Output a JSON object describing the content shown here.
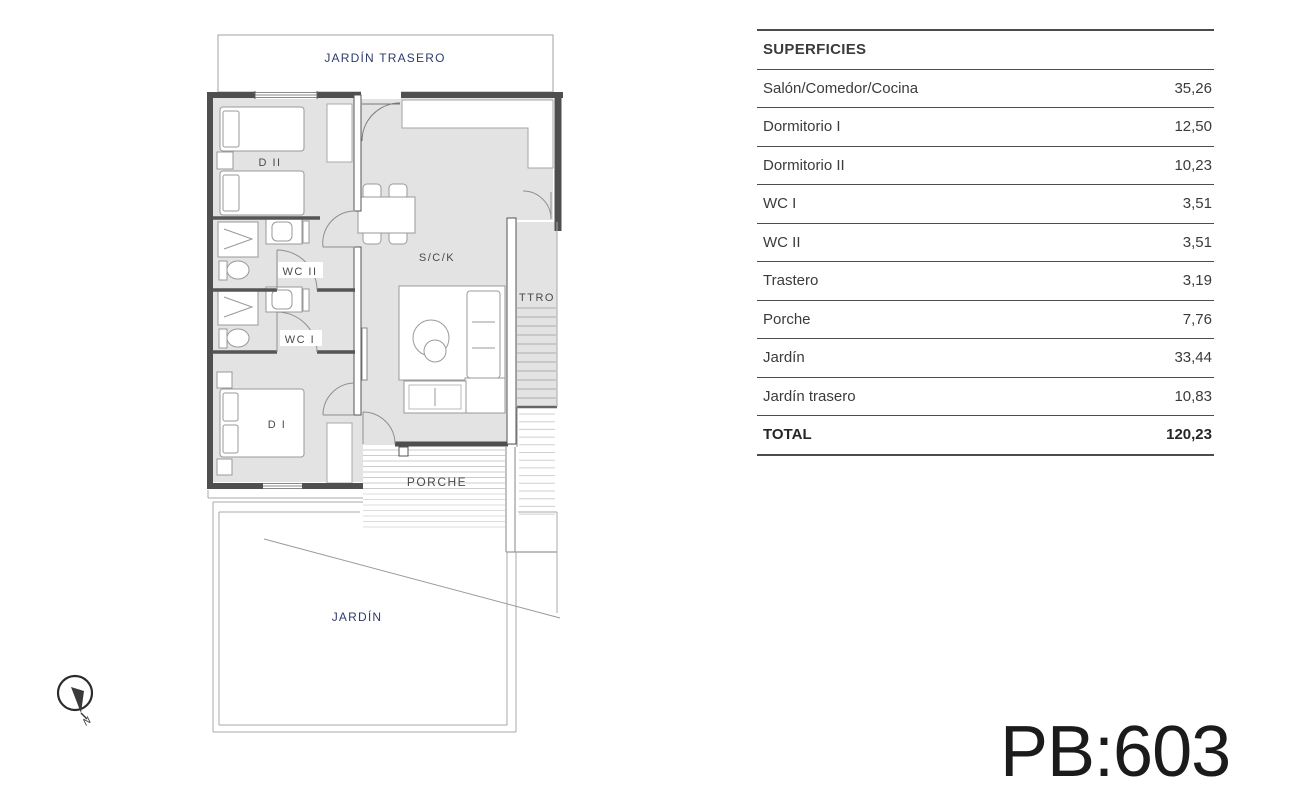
{
  "floor_plan": {
    "labels": {
      "jardin_trasero": "JARDÍN TRASERO",
      "d2": "D II",
      "wc2": "WC II",
      "wc1": "WC I",
      "d1": "D I",
      "sck": "S/C/K",
      "ttro": "TTRO",
      "porche": "PORCHE",
      "jardin": "JARDÍN"
    },
    "compass_label": "N"
  },
  "table": {
    "header": "SUPERFICIES",
    "rows": [
      {
        "label": "Salón/Comedor/Cocina",
        "value": "35,26"
      },
      {
        "label": "Dormitorio I",
        "value": "12,50"
      },
      {
        "label": "Dormitorio II",
        "value": "10,23"
      },
      {
        "label": "WC I",
        "value": "3,51"
      },
      {
        "label": "WC II",
        "value": "3,51"
      },
      {
        "label": "Trastero",
        "value": "3,19"
      },
      {
        "label": "Porche",
        "value": "7,76"
      },
      {
        "label": "Jardín",
        "value": "33,44"
      },
      {
        "label": "Jardín trasero",
        "value": "10,83"
      }
    ],
    "total": {
      "label": "TOTAL",
      "value": "120,23"
    }
  },
  "plan_code": "PB:603",
  "colors": {
    "floor_gray": "#e3e3e3",
    "wall_dark": "#4f4f4f",
    "label_navy": "#2e3b6e",
    "text_dark": "#3b3b3b",
    "hatch_gray": "#cccccc"
  }
}
